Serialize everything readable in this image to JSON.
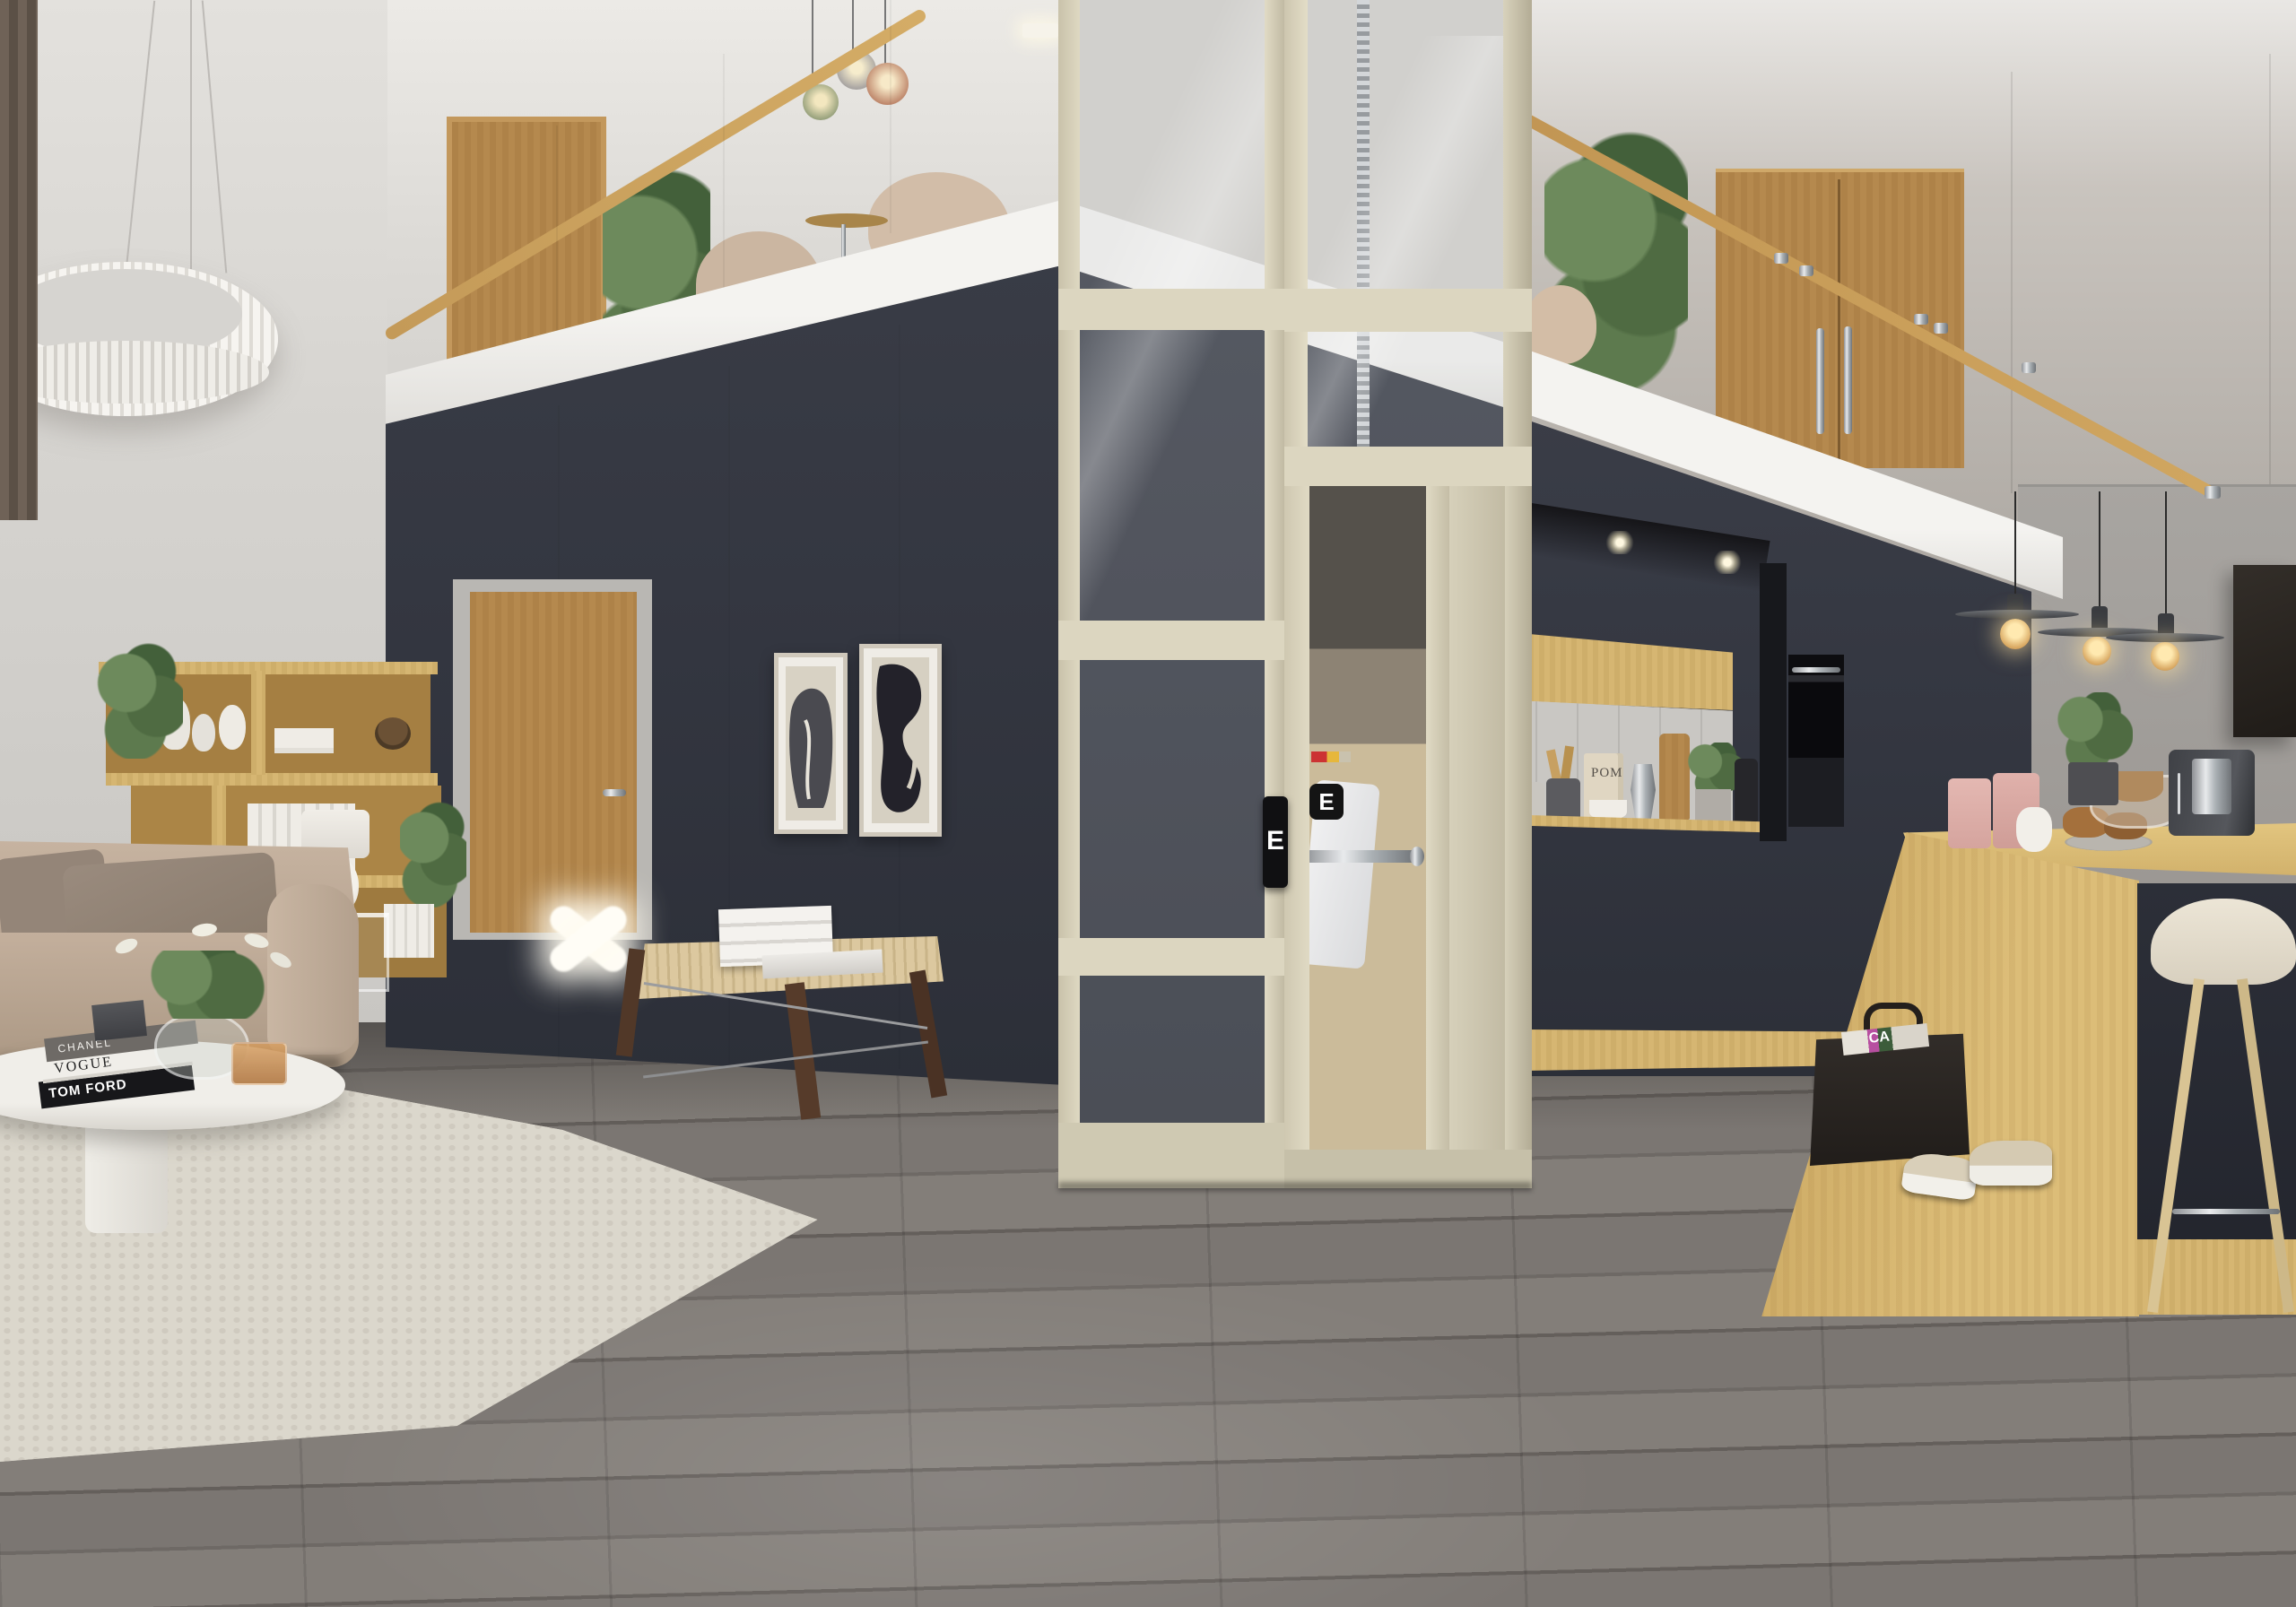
{
  "scene": {
    "type": "interior-3d-render",
    "description": "Double-height modern loft: living area, dark feature cube, glass home elevator with cream frame, navy kitchen, light-wood island, mezzanine with glass balustrade",
    "palette": {
      "wall_light": "#d6d4d0",
      "wall_right_gray": "#a29e9a",
      "navy_cabinetry": "#343741",
      "elevator_cream": "#dcd6c0",
      "oak_wood": "#b5894e",
      "island_wood": "#d6b672",
      "floor_gray_wood": "#756f6b",
      "rug_cream": "#d9d5ca",
      "sofa_beige": "#c0ac99",
      "accent_chrome": "#b9bcc0"
    }
  },
  "elevator": {
    "door_logo": "E",
    "call_panel_label": "E"
  },
  "coffee_table_books": {
    "top": "CHANEL",
    "middle": "VOGUE",
    "bottom": "TOM FORD"
  },
  "kitchen": {
    "cookbook_label": "POM"
  },
  "magazine_basket": {
    "visible_letters": "CA"
  },
  "objects": [
    "ring-chandelier",
    "brown-curtain",
    "beige-sofa",
    "white-oval-coffee-table",
    "glass-tulip-vase",
    "amber-candle-holder",
    "wood-shelving-unit",
    "white-table-lamp",
    "oak-interior-door",
    "x-shaped-floor-lamp",
    "woven-bench",
    "white-book-stack",
    "framed-abstract-art-pair",
    "glass-home-elevator",
    "chrome-screw-drive",
    "mezzanine-glass-balustrade",
    "oak-handrail",
    "pendant-globe-trio",
    "beige-armchairs",
    "double-oak-doors",
    "potted-tree",
    "navy-kitchen",
    "oak-upper-cabinet",
    "tile-backsplash",
    "built-in-oven",
    "soffit-spotlights",
    "oak-island",
    "bar-stool",
    "espresso-machine",
    "pink-cups",
    "pastry-plate",
    "wood-bowls",
    "disc-pendant-lights",
    "dark-wall-artwork",
    "leather-magazine-basket",
    "sneakers"
  ]
}
